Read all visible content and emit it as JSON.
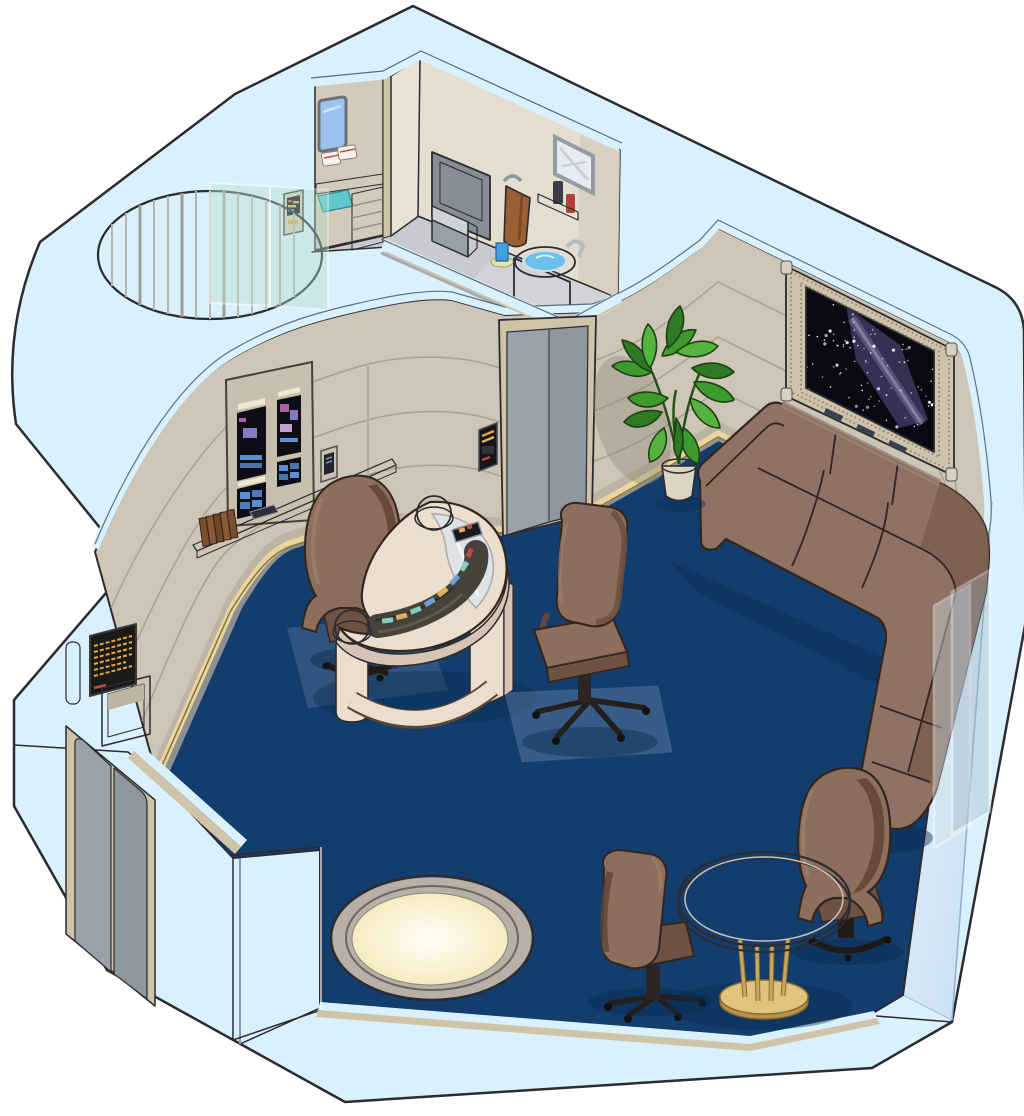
{
  "scene": {
    "type": "isometric-cutaway-room-illustration",
    "setting": "starship-crew-quarters",
    "areas": [
      "living-area",
      "bathroom",
      "closet-alcove",
      "sonic-shower"
    ],
    "objects": [
      "exterior-shell-walls",
      "exterior-double-door",
      "interior-sliding-door",
      "door-control-panel",
      "wall-display-panel",
      "wall-shelf",
      "books",
      "padd-tablet",
      "standing-tablet",
      "replicator-alcove",
      "replicator-screen",
      "viewport-window",
      "starfield",
      "sectional-couch",
      "potted-plant",
      "glass-partition",
      "crescent-desk",
      "desk-dome-left",
      "desk-dome-right",
      "desk-console",
      "desktop-monitor",
      "captain-chair",
      "office-chair-center",
      "office-chair-lower",
      "wing-chair",
      "round-table",
      "floor-light",
      "sonic-shower-cylinder",
      "shower-glass-panel",
      "closet-window",
      "closet-towels",
      "closet-drawers",
      "closet-control-panel",
      "bathroom-mat",
      "toilet",
      "hand-towel",
      "towel-hook",
      "mirror",
      "bathroom-shelf",
      "bottles",
      "sink-basin",
      "sink-faucet",
      "cup",
      "soap-dish",
      "carpet"
    ]
  },
  "colors": {
    "outline": "#2b2b30",
    "shellTop": "#d9f1fc",
    "shellFaceA": "#eef7fe",
    "shellFaceB": "#b9d7ef",
    "shellFace2A": "#e8f4fd",
    "shellFace2B": "#c2dcf0",
    "trimTan": "#cfc3a8",
    "floor": "#123d6d",
    "floorShadow": "#0a2c50",
    "wall": "#cdc5b6",
    "wallGroove": "#a69d8e",
    "wallDark": "#b7ae9f",
    "baseTan": "#e7d69e",
    "baseLine": "#8a6f3f",
    "bathFloor": "#c9cad0",
    "bathFloorDark": "#a7abb3",
    "bathWallLeft": "#d3cabb",
    "bathWallMid": "#e9e3d6",
    "bathWallRight": "#e4ded0",
    "fixtureGray": "#9aa0a8",
    "fixtureDark": "#878d94",
    "fixtureLight": "#ced3d8",
    "towel": "#9a5f33",
    "water": "#6cc0ee",
    "matTeal": "#5fc8cc",
    "couch": "#8f7263",
    "couchDark": "#7c5f50",
    "couchLine": "#33251c",
    "chair": "#8d6e5c",
    "chairDark": "#6d5142",
    "chairDeep": "#5f4536",
    "blackBase": "#1f1b18",
    "desk": "#ecdecd",
    "deskSide": "#d8c4b2",
    "deskGlass": "#dfe4e8",
    "console": "#45423a",
    "teal": "#7fd0c0",
    "gold": "#e0b060",
    "blue": "#6f9fd8",
    "red": "#c04b3e",
    "screen": "#0d0d15",
    "screenBlue": "#5a8fd4",
    "purple": "#8a78c0",
    "pink": "#b060a0",
    "amber": "#e2a93e",
    "windowFrame": "#cdc2ac",
    "braid": "#96865f",
    "bezel": "#8ea2bc",
    "bezelDark": "#7f95ae",
    "space": "#0a0a13",
    "nebula": "#453d6b",
    "nebulaCore": "#9a8fc4",
    "plant1": "#2e7a22",
    "plant2": "#3f9a2e",
    "plant3": "#57b33f",
    "pot": "#dcd5c2",
    "tableTop": "#e8e0d2",
    "brass": "#c9a75c",
    "brassDark": "#8a6a30",
    "lightRing": "#b7b0a7",
    "lightGlow": "#f2e5b2",
    "doorGray": "#9aa1a8",
    "doorGrayDark": "#8f969d",
    "glassGreen": "#bfe0cf"
  },
  "starfield": {
    "star_count": 90
  }
}
